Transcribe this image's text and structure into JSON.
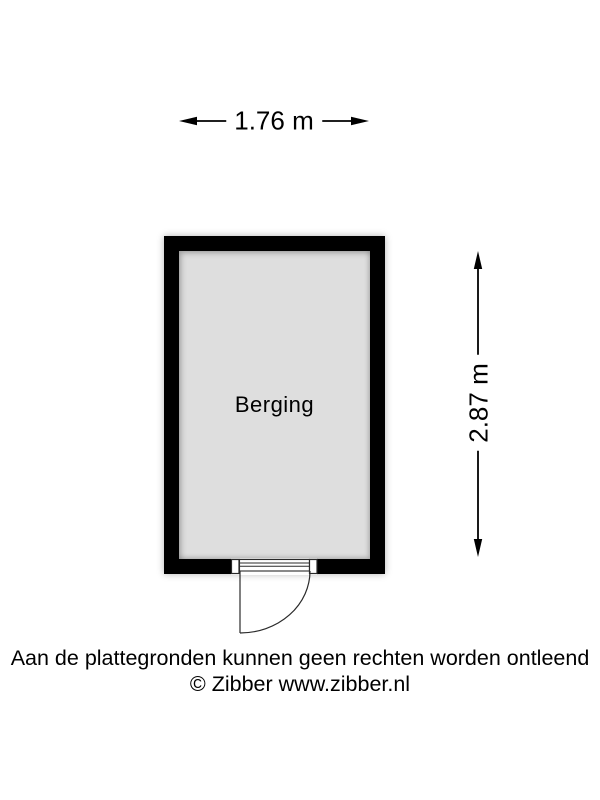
{
  "floorplan": {
    "room": {
      "label": "Berging"
    },
    "dimensions": {
      "width_label": "1.76 m",
      "height_label": "2.87 m"
    },
    "colors": {
      "wall": "#000000",
      "floor": "#dedede",
      "text": "#000000",
      "background": "#ffffff"
    }
  },
  "footer": {
    "disclaimer": "Aan de plattegronden kunnen geen rechten worden ontleend",
    "copyright": "© Zibber www.zibber.nl"
  }
}
